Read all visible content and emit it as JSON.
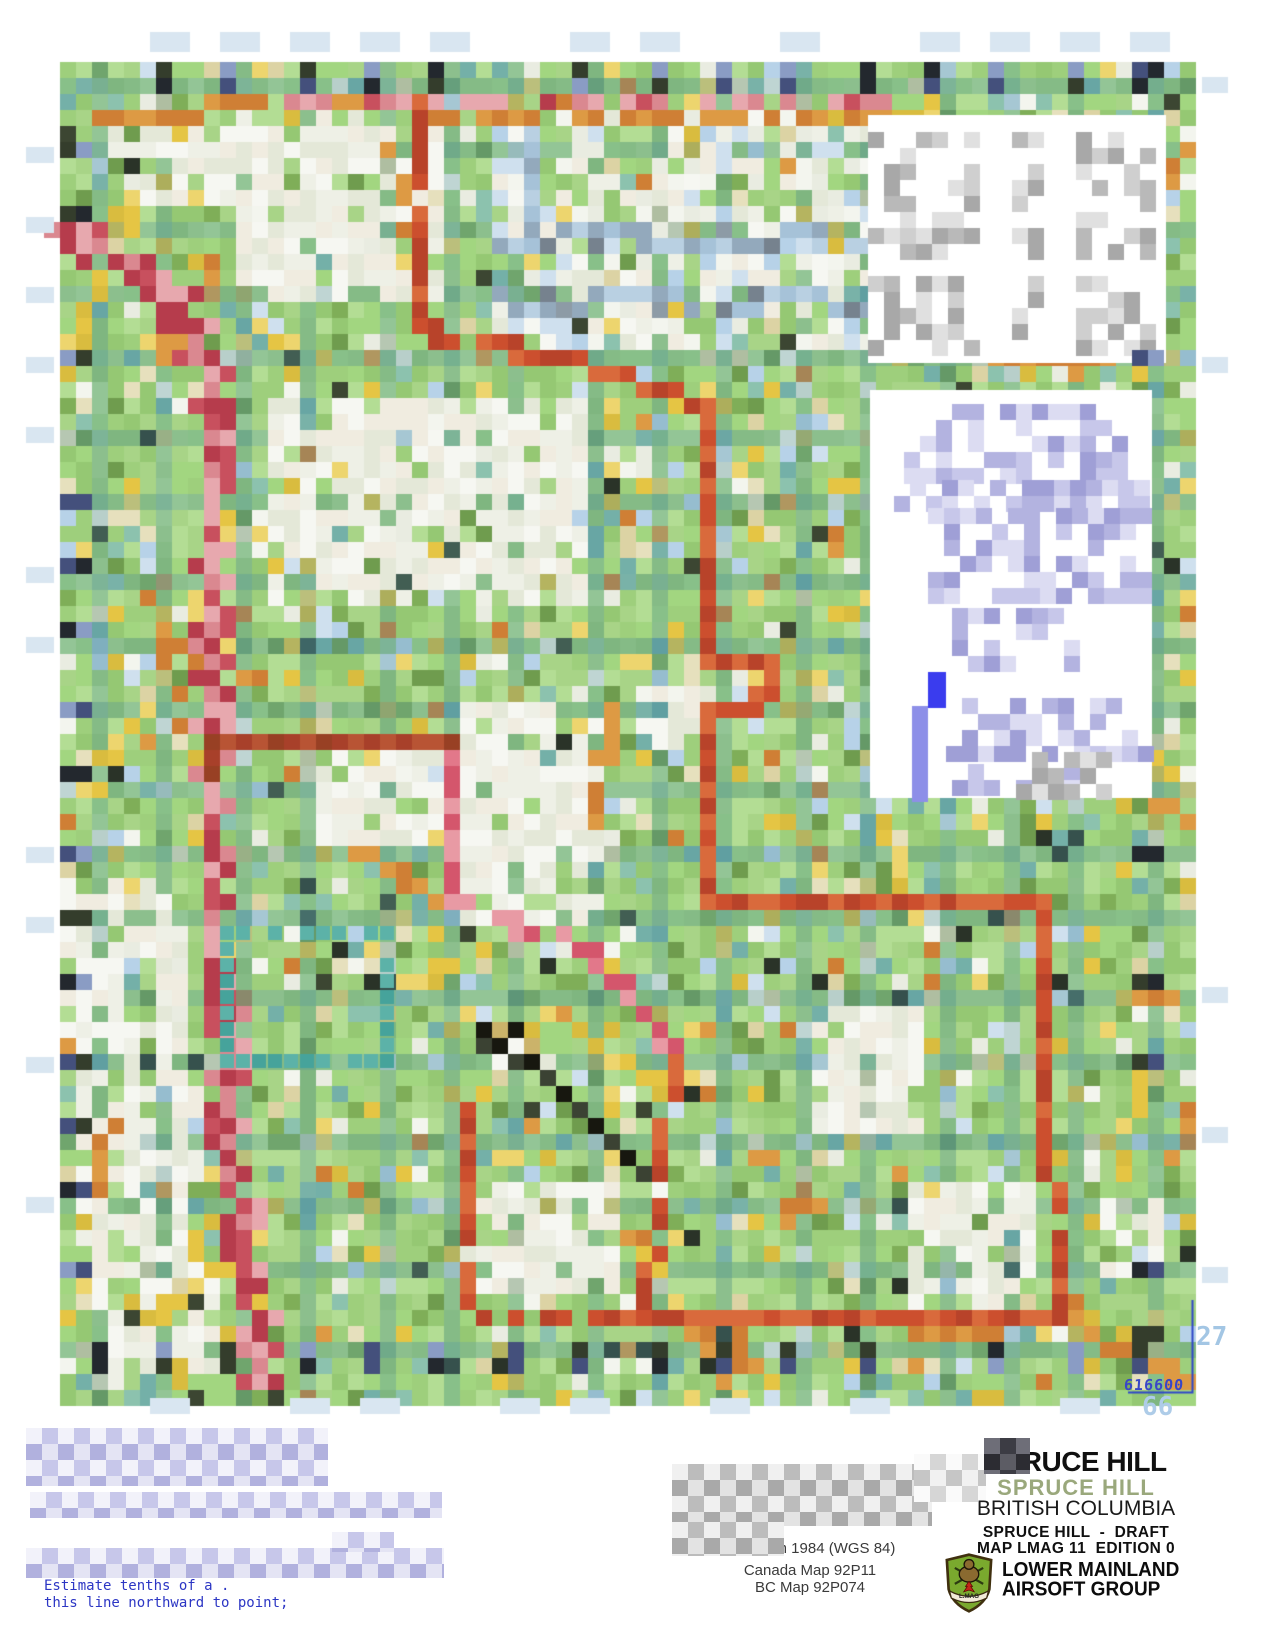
{
  "map": {
    "description": "Pixelated topographic game-area map of Spruce Hill",
    "grid_labels": {
      "easting_label": "27",
      "corner_coordinate": "616600",
      "northing_label": "66"
    }
  },
  "title_block": {
    "title_primary": "SPRUCE HILL",
    "title_secondary": "SPRUCE HILL",
    "region": "BRITISH COLUMBIA",
    "status_line": "SPRUCE HILL  -  DRAFT",
    "edition_line": "MAP LMAG 11  EDITION 0"
  },
  "logo": {
    "org_line1": "LOWER MAINLAND",
    "org_line2": "AIRSOFT GROUP",
    "shield_banner": "L.MAG"
  },
  "notes": {
    "datum_note": "System 1984 (WGS 84)",
    "source_note_1": "Canada Map 92P11",
    "source_note_2": "BC Map 92P074",
    "margin_instruction_line1": "Estimate tenths of a .",
    "margin_instruction_line2": "this line northward to point;"
  },
  "colors": {
    "base_greens": [
      "#a8d487",
      "#9ecf7c",
      "#b3dd94",
      "#95c873",
      "#a2d680"
    ],
    "accent_yellow": [
      "#e5c544",
      "#d9bc3f",
      "#edd56e"
    ],
    "accent_tan": [
      "#dcd3a4",
      "#e6e0bd"
    ],
    "accent_teal": [
      "#8cc2ae",
      "#74b0a8"
    ],
    "accent_lightblue": [
      "#b7d2e8",
      "#cfe0ee"
    ],
    "accent_white": [
      "#f3f5ee",
      "#e9ece1"
    ],
    "accent_olive": [
      "#7fae58",
      "#6f9c4e"
    ],
    "accent_orange": [
      "#dd9a44",
      "#cf7f35"
    ],
    "accent_dark": [
      "#3c4632",
      "#2a3328"
    ],
    "edge_mark": [
      "#343d2c",
      "#44507c",
      "#8a9cc4",
      "#23282e"
    ],
    "grid_tint": "rgba(80,145,155,0.32)",
    "road_red": [
      "#c8505e",
      "#da8890",
      "#b63c4c",
      "#e7a8ae"
    ],
    "boundary_red": [
      "#cc4f2e",
      "#d96a3c",
      "#b8432a"
    ],
    "boundary_dark": [
      "#a8402a",
      "#984024",
      "#b85434"
    ],
    "boundary_pink": [
      "#e2788a",
      "#d4566c",
      "#e89aa4"
    ],
    "stream_blue": [
      "#b9d0e2",
      "#a6c2d8",
      "#93a9bc"
    ],
    "stream_gray": [
      "#8d9ba6",
      "#76828e"
    ],
    "white_clearing": [
      "#f6f7f2",
      "#eef0e6",
      "#e4e8d8",
      "#f0ece0"
    ],
    "teal_feature": [
      "#46a39b",
      "#5cb2a8"
    ],
    "dark_feature": [
      "#17170f",
      "#3b4233",
      "#cbb36a"
    ],
    "panel_gray": [
      "#b9b9b9",
      "#cfcfcf",
      "#e0e0e0",
      "#a8a8a8"
    ],
    "panel_lavender": [
      "#c7c7ea",
      "#b3b3e0",
      "#dcdcf2",
      "#9f9fd6"
    ],
    "arrow_blue": "#3a3cee",
    "arrow_blue_light": "#8d8fe8",
    "neatline_blue": "#2f46c8",
    "tick_blue": "#d9e6f1"
  }
}
